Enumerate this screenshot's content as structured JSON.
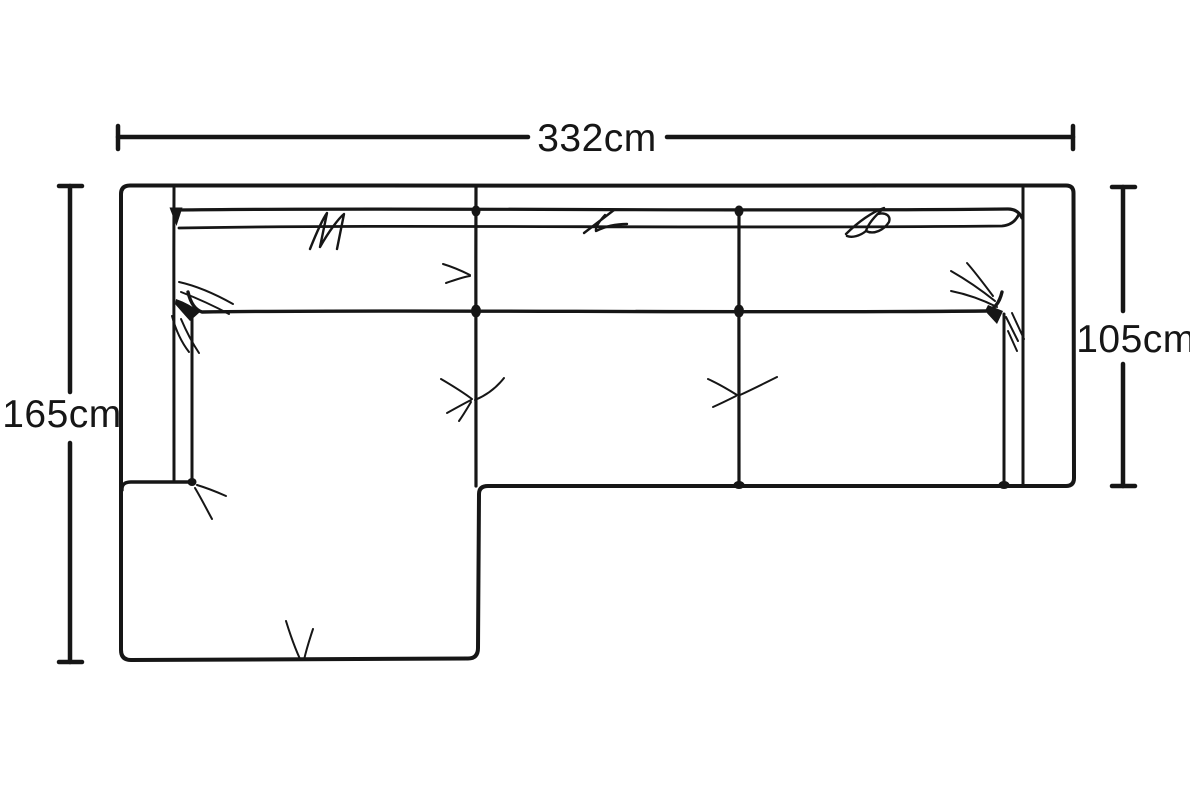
{
  "diagram": {
    "labels": {
      "overall_width": "332cm",
      "chaise_depth": "165cm",
      "seat_depth": "105cm"
    },
    "colors": {
      "ink": "#161616",
      "background": "#ffffff"
    }
  }
}
